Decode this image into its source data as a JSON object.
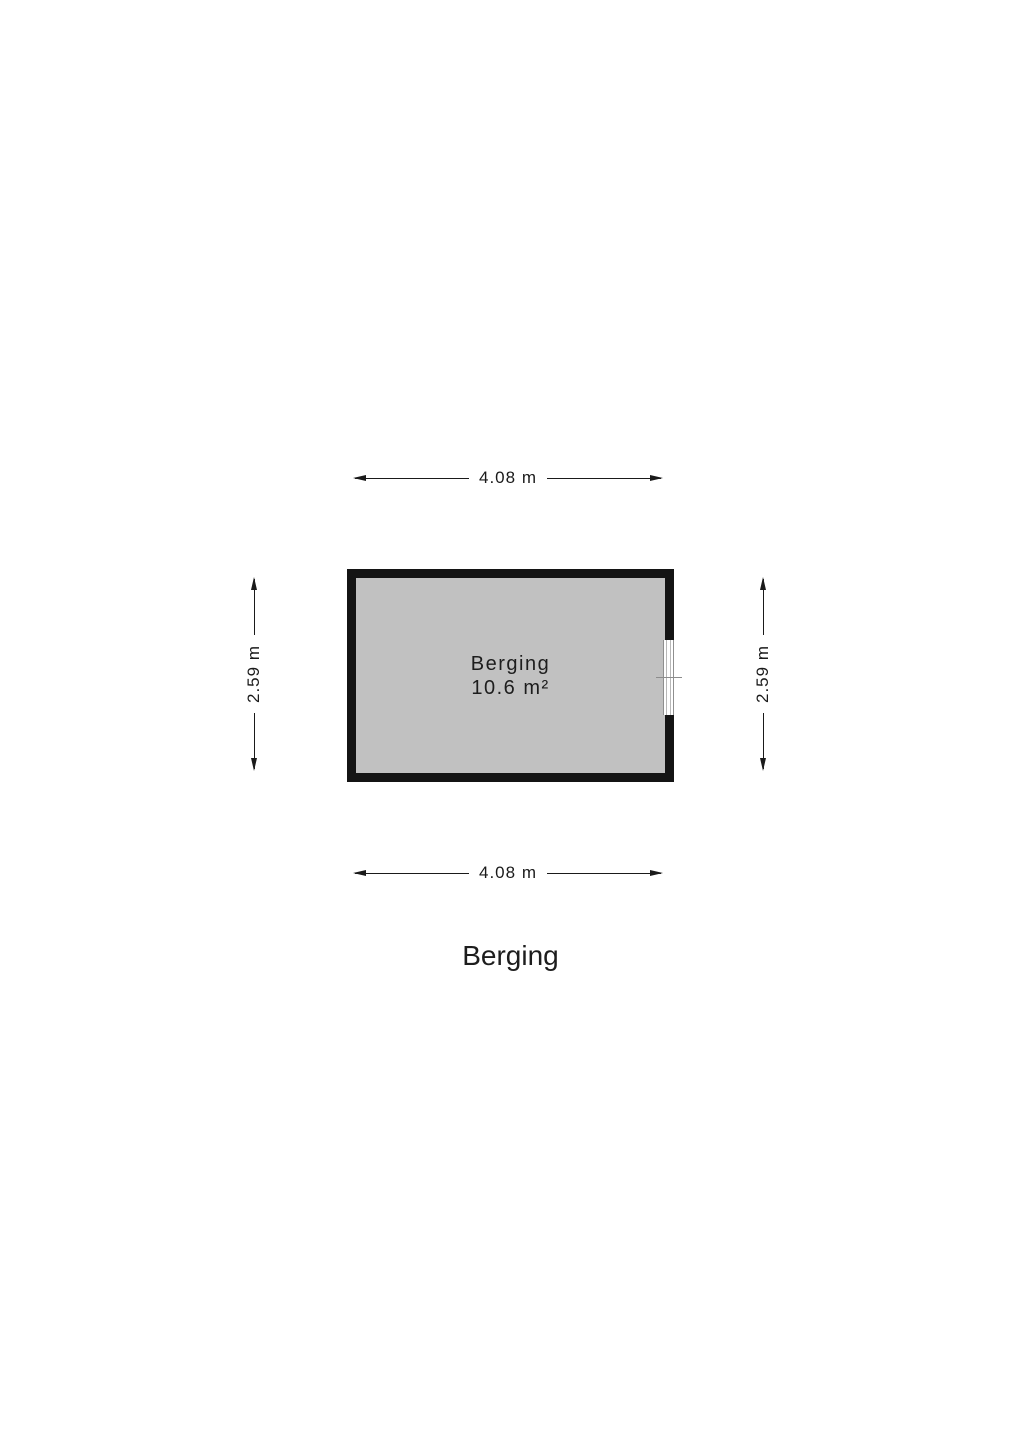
{
  "floorplan": {
    "title": "Berging",
    "room": {
      "name": "Berging",
      "area": "10.6 m²",
      "fill_color": "#c1c1c1",
      "wall_color": "#141414"
    },
    "dimensions": {
      "top": "4.08 m",
      "bottom": "4.08 m",
      "left": "2.59 m",
      "right": "2.59 m"
    },
    "icons": {
      "window_symbol": "window-on-right-wall",
      "arrow_style": "double-headed-dimension-arrow"
    },
    "colors": {
      "background": "#ffffff",
      "dimension_line": "#1a1a1a",
      "window_line": "#8f8f8f",
      "text": "#1d1d1d"
    }
  }
}
